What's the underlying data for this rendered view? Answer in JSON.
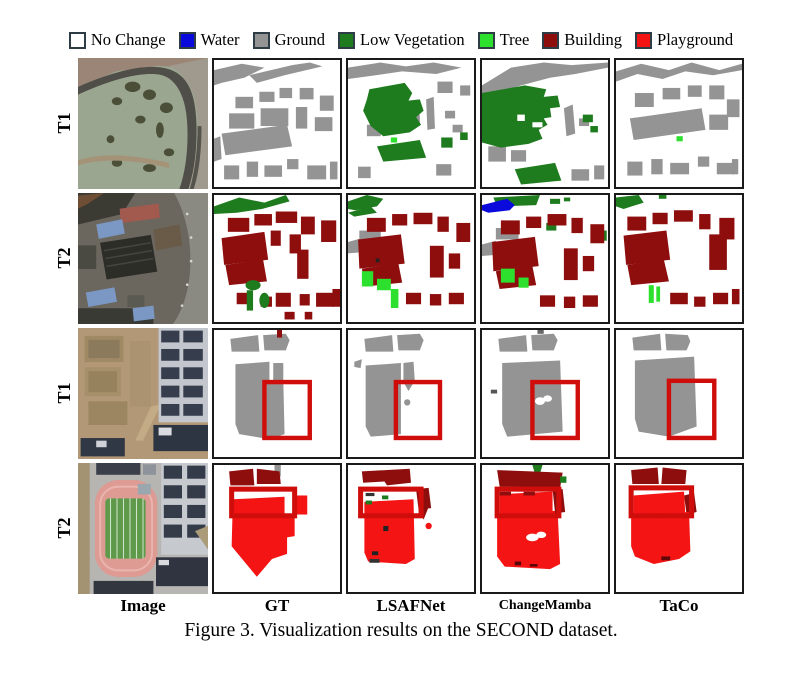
{
  "legend": {
    "items": [
      {
        "label": "No Change",
        "color": "#ffffff"
      },
      {
        "label": "Water",
        "color": "#0a0adc"
      },
      {
        "label": "Ground",
        "color": "#949494"
      },
      {
        "label": "Low Vegetation",
        "color": "#1e7b1e"
      },
      {
        "label": "Tree",
        "color": "#2ee02e"
      },
      {
        "label": "Building",
        "color": "#8e0e0e"
      },
      {
        "label": "Playground",
        "color": "#f41414"
      }
    ]
  },
  "grid": {
    "row_labels": [
      "T1",
      "T2",
      "T1",
      "T2"
    ],
    "column_labels": [
      "Image",
      "GT",
      "LSAFNet",
      "ChangeMamba",
      "TaCo"
    ],
    "highlight_box_color": "#cf0e0c"
  },
  "caption": "Figure 3. Visualization results on the SECOND dataset."
}
